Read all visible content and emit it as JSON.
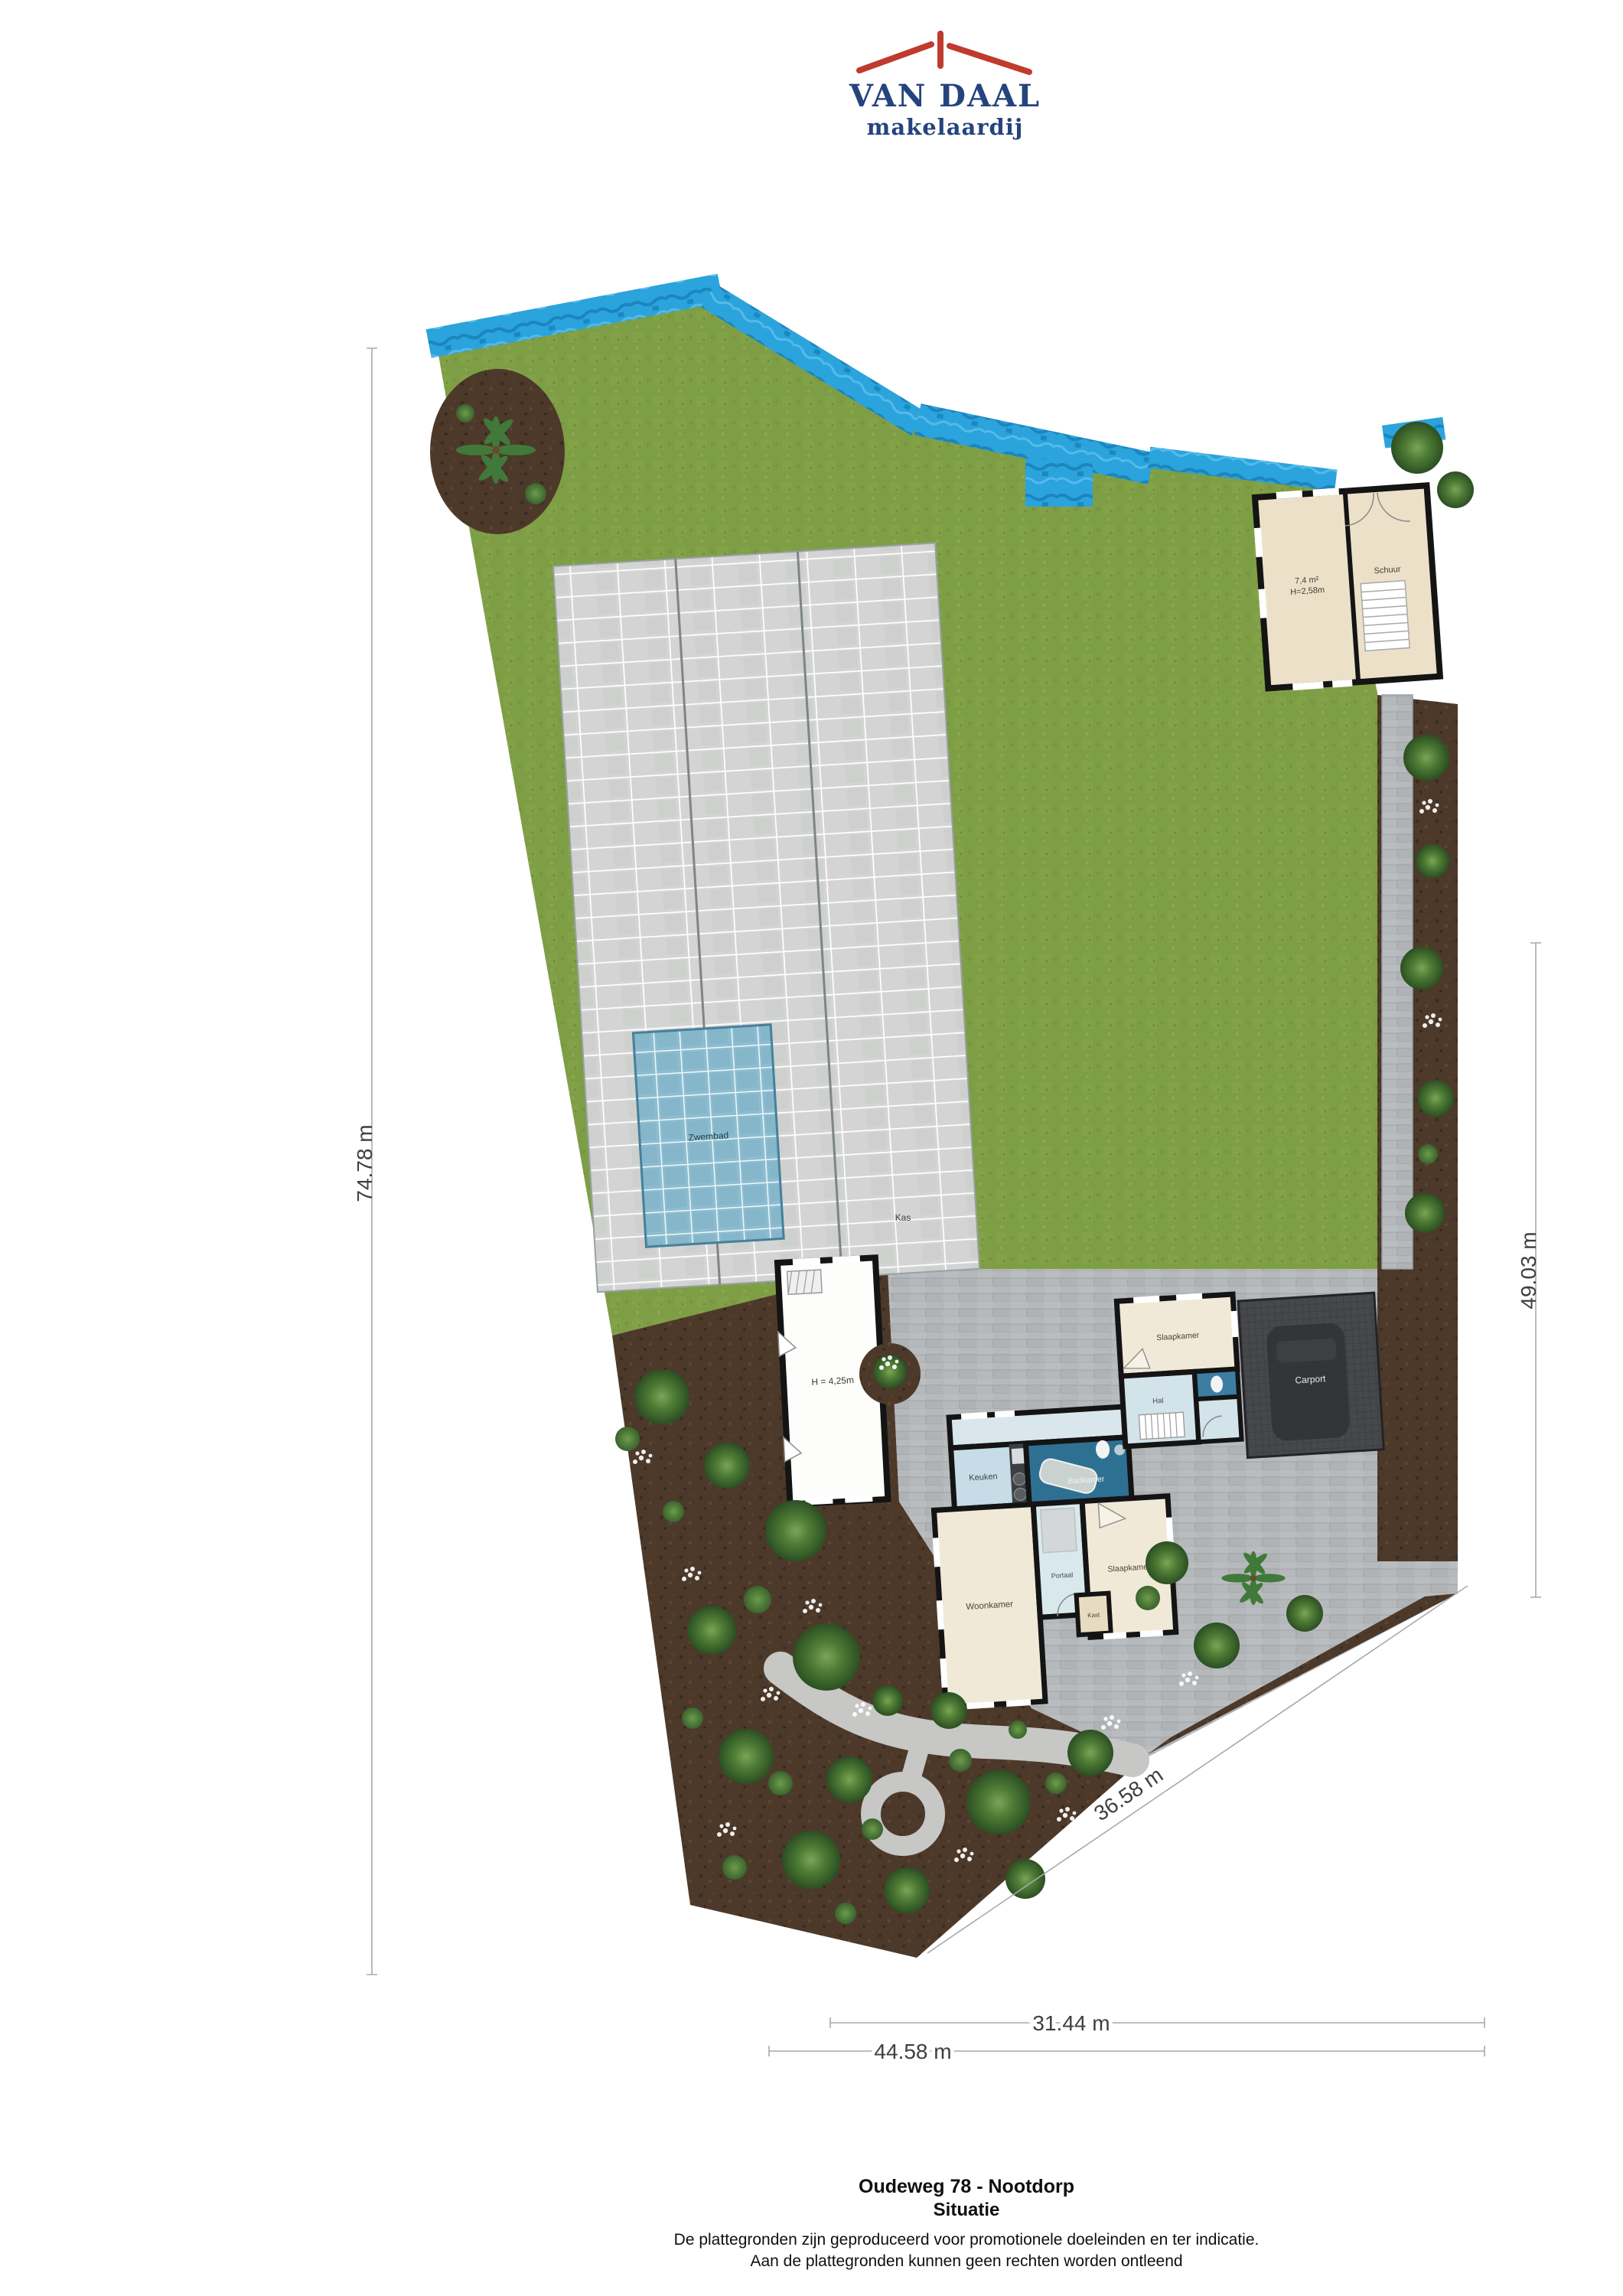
{
  "logo": {
    "brand": "VAN DAAL",
    "tagline": "makelaardij"
  },
  "site": {
    "labels": {
      "kas": "Kas",
      "zwembad": "Zwembad",
      "barn_height": "H = 4,25m",
      "outbuilding_area": "7,4 m²",
      "outbuilding_height": "H=2,58m",
      "outbuilding_room": "Schuur",
      "carport": "Carport"
    },
    "rooms": {
      "slaapkamer_boven": "Slaapkamer",
      "hal": "Hal",
      "keuken": "Keuken",
      "badkamer": "Badkamer",
      "woonkamer": "Woonkamer",
      "portaal": "Portaal",
      "slaapkamer": "Slaapkamer",
      "kast": "Kast"
    },
    "dimensions": {
      "left": "74.78 m",
      "right": "49.03 m",
      "diagonal": "36.58 m",
      "bottom_upper": "31.44 m",
      "bottom_lower": "44.58 m"
    }
  },
  "footer": {
    "address": "Oudeweg 78 - Nootdorp",
    "sheet": "Situatie",
    "disclaimer_line1": "De plattegronden zijn geproduceerd voor promotionele doeleinden en ter indicatie.",
    "disclaimer_line2": "Aan de plattegronden kunnen geen rechten worden ontleend"
  }
}
